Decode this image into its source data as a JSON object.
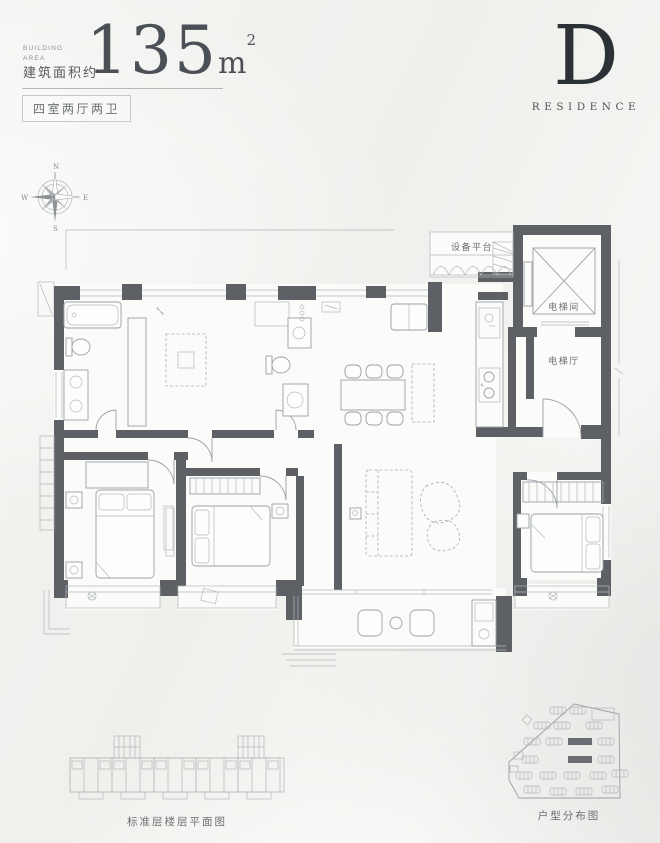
{
  "header": {
    "area_label_en_line1": "BUILDING",
    "area_label_en_line2": "AREA",
    "area_label_zh": "建筑面积约",
    "area_value": "135",
    "area_unit_base": "m",
    "area_unit_exp": "2",
    "layout_tag": "四室两厅两卫"
  },
  "brand": {
    "letter": "D",
    "name": "RESIDENCE"
  },
  "compass": {
    "n": "N",
    "e": "E",
    "s": "S",
    "w": "W"
  },
  "plan_labels": {
    "equipment_platform": "设备平台",
    "elevator_room": "电梯间",
    "elevator_hall": "电梯厅"
  },
  "captions": {
    "floor_plate": "标准层楼层平面图",
    "site_map": "户型分布图"
  },
  "colors": {
    "wall": "#5d6166",
    "line": "#9aa0a5",
    "light_line": "#b3b8bb",
    "text_dark": "#2c3136",
    "text_gray": "#6b7075",
    "background": "#f2f2f0",
    "highlight_unit": "#6a6e73"
  }
}
